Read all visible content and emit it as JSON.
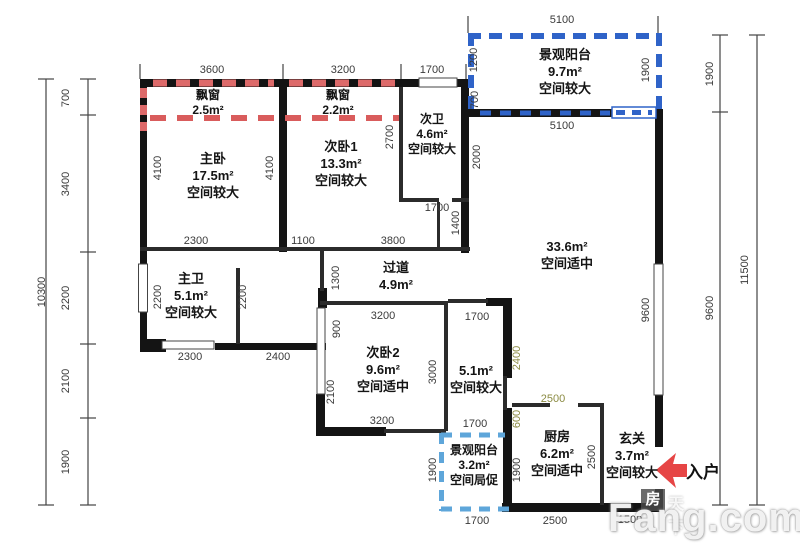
{
  "entry": {
    "label": "入户"
  },
  "watermark": {
    "logo": "房",
    "ghost": "天下",
    "brand": "Fang.com"
  },
  "colors": {
    "wall": "#141414",
    "bay_window_dash": "#dd6a6a",
    "balcony_top_dash": "#2f63c8",
    "balcony_bottom_dash": "#5ea6da",
    "entry_arrow": "#e64545",
    "dim_olive": "#8b8b42"
  },
  "rooms": [
    {
      "lines": [
        "飘窗",
        "2.5m²"
      ],
      "x": 208,
      "y": 88,
      "small": true
    },
    {
      "lines": [
        "飘窗",
        "2.2m²"
      ],
      "x": 338,
      "y": 88,
      "small": true
    },
    {
      "lines": [
        "主卧",
        "17.5m²",
        "空间较大"
      ],
      "x": 213,
      "y": 150,
      "small": false
    },
    {
      "lines": [
        "次卧1",
        "13.3m²",
        "空间较大"
      ],
      "x": 341,
      "y": 138,
      "small": false
    },
    {
      "lines": [
        "次卫",
        "4.6m²",
        "空间较大"
      ],
      "x": 432,
      "y": 112,
      "small": true
    },
    {
      "lines": [
        "景观阳台",
        "9.7m²",
        "空间较大"
      ],
      "x": 565,
      "y": 46,
      "small": false
    },
    {
      "lines": [
        "33.6m²",
        "空间适中"
      ],
      "x": 567,
      "y": 238,
      "small": false
    },
    {
      "lines": [
        "过道",
        "4.9m²"
      ],
      "x": 396,
      "y": 259,
      "small": false
    },
    {
      "lines": [
        "主卫",
        "5.1m²",
        "空间较大"
      ],
      "x": 191,
      "y": 270,
      "small": false
    },
    {
      "lines": [
        "次卧2",
        "9.6m²",
        "空间适中"
      ],
      "x": 383,
      "y": 344,
      "small": false
    },
    {
      "lines": [
        "5.1m²",
        "空间较大"
      ],
      "x": 476,
      "y": 362,
      "small": false
    },
    {
      "lines": [
        "景观阳台",
        "3.2m²",
        "空间局促"
      ],
      "x": 474,
      "y": 443,
      "small": true
    },
    {
      "lines": [
        "厨房",
        "6.2m²",
        "空间适中"
      ],
      "x": 557,
      "y": 428,
      "small": false
    },
    {
      "lines": [
        "玄关",
        "3.7m²",
        "空间较大"
      ],
      "x": 632,
      "y": 430,
      "small": false
    }
  ],
  "dims": [
    {
      "t": "3600",
      "x": 212,
      "y": 70
    },
    {
      "t": "3200",
      "x": 343,
      "y": 70
    },
    {
      "t": "1700",
      "x": 432,
      "y": 70
    },
    {
      "t": "5100",
      "x": 562,
      "y": 20
    },
    {
      "t": "700",
      "x": 66,
      "y": 98,
      "r": 1
    },
    {
      "t": "3400",
      "x": 66,
      "y": 184,
      "r": 1
    },
    {
      "t": "2200",
      "x": 66,
      "y": 298,
      "r": 1
    },
    {
      "t": "2100",
      "x": 66,
      "y": 381,
      "r": 1
    },
    {
      "t": "1900",
      "x": 66,
      "y": 462,
      "r": 1
    },
    {
      "t": "10300",
      "x": 42,
      "y": 292,
      "r": 1
    },
    {
      "t": "1900",
      "x": 710,
      "y": 74,
      "r": 1
    },
    {
      "t": "9600",
      "x": 710,
      "y": 308,
      "r": 1
    },
    {
      "t": "11500",
      "x": 745,
      "y": 270,
      "r": 1
    },
    {
      "t": "4100",
      "x": 158,
      "y": 168,
      "r": 1
    },
    {
      "t": "4100",
      "x": 270,
      "y": 168,
      "r": 1
    },
    {
      "t": "2700",
      "x": 390,
      "y": 137,
      "r": 1
    },
    {
      "t": "1200",
      "x": 474,
      "y": 60,
      "r": 1
    },
    {
      "t": "700",
      "x": 475,
      "y": 100,
      "r": 1
    },
    {
      "t": "2000",
      "x": 477,
      "y": 157,
      "r": 1
    },
    {
      "t": "1900",
      "x": 646,
      "y": 70,
      "r": 1
    },
    {
      "t": "5100",
      "x": 562,
      "y": 126
    },
    {
      "t": "2300",
      "x": 196,
      "y": 241
    },
    {
      "t": "1100",
      "x": 303,
      "y": 241
    },
    {
      "t": "3800",
      "x": 393,
      "y": 241
    },
    {
      "t": "1700",
      "x": 437,
      "y": 208
    },
    {
      "t": "1400",
      "x": 456,
      "y": 223,
      "r": 1
    },
    {
      "t": "2200",
      "x": 158,
      "y": 297,
      "r": 1
    },
    {
      "t": "2200",
      "x": 243,
      "y": 297,
      "r": 1
    },
    {
      "t": "1300",
      "x": 336,
      "y": 278,
      "r": 1
    },
    {
      "t": "2300",
      "x": 190,
      "y": 357
    },
    {
      "t": "2400",
      "x": 278,
      "y": 357
    },
    {
      "t": "900",
      "x": 337,
      "y": 329,
      "r": 1
    },
    {
      "t": "2100",
      "x": 331,
      "y": 392,
      "r": 1
    },
    {
      "t": "3200",
      "x": 383,
      "y": 316
    },
    {
      "t": "3000",
      "x": 433,
      "y": 372,
      "r": 1
    },
    {
      "t": "1700",
      "x": 477,
      "y": 317
    },
    {
      "t": "2400",
      "x": 517,
      "y": 358,
      "r": 1,
      "c": "olive"
    },
    {
      "t": "600",
      "x": 517,
      "y": 419,
      "r": 1,
      "c": "olive"
    },
    {
      "t": "3200",
      "x": 382,
      "y": 421
    },
    {
      "t": "1700",
      "x": 475,
      "y": 424
    },
    {
      "t": "1900",
      "x": 433,
      "y": 470,
      "r": 1
    },
    {
      "t": "1900",
      "x": 517,
      "y": 470,
      "r": 1
    },
    {
      "t": "2500",
      "x": 553,
      "y": 399,
      "c": "olive"
    },
    {
      "t": "2500",
      "x": 592,
      "y": 457,
      "r": 1
    },
    {
      "t": "9600",
      "x": 646,
      "y": 310,
      "r": 1
    },
    {
      "t": "1700",
      "x": 477,
      "y": 521
    },
    {
      "t": "2500",
      "x": 555,
      "y": 521
    },
    {
      "t": "1500",
      "x": 630,
      "y": 520
    }
  ]
}
